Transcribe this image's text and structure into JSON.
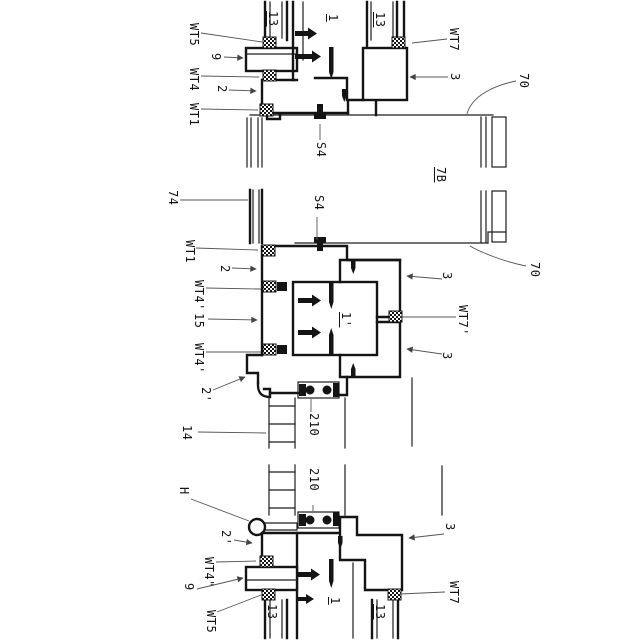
{
  "colors": {
    "background": "#ffffff",
    "line": "#141414",
    "leader": "#555555"
  },
  "labels": {
    "t_wt5": "WT5",
    "t_9": "9",
    "t_wt4": "WT4",
    "t_2": "2",
    "t_wt1": "WT1",
    "t_13a": "13",
    "t_1": "1",
    "t_13b": "13",
    "t_wt7": "WT7",
    "t_3": "3",
    "t_70": "70",
    "t_s4": "S4",
    "t_7b": "7B",
    "m_74": "74",
    "m_s4": "S4",
    "m_wt1": "WT1",
    "m_2": "2",
    "m_wt4p1": "WT4'",
    "m_15": "15",
    "m_wt4p2": "WT4'",
    "m_2p": "2'",
    "m_14": "14",
    "m_210": "210",
    "m_1p": "1'",
    "m_3u": "3",
    "m_wt7p": "WT7'",
    "m_3l": "3",
    "m_70": "70",
    "b_h": "H",
    "b_210": "210",
    "b_2p": "2'",
    "b_wt4pp": "WT4\"",
    "b_9": "9",
    "b_wt5": "WT5",
    "b_13a": "13",
    "b_1": "1",
    "b_13b": "13",
    "b_3": "3",
    "b_wt7": "WT7"
  }
}
